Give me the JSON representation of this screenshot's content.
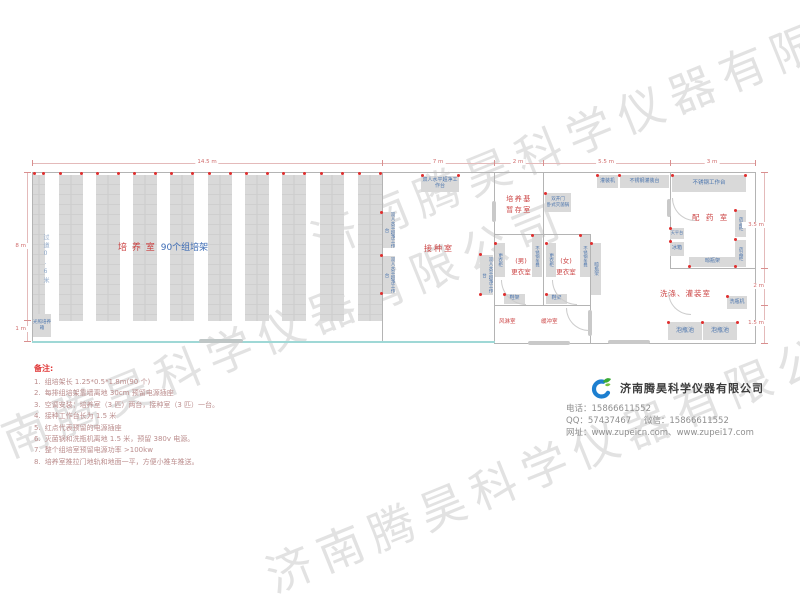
{
  "watermark": {
    "text": "济南腾昊科学仪器有限公司"
  },
  "dims": {
    "top": [
      "14.5 m",
      "7 m",
      "2 m",
      "5.5 m",
      "3 m"
    ],
    "left": [
      "8 m",
      "1 m"
    ],
    "right": [
      "3.5 m",
      "2 m",
      "1.5 m"
    ]
  },
  "plan": {
    "culture_room": {
      "name": "培 养 室",
      "rack_note": "90个组培架",
      "aisle": "过道0.6米",
      "incubator": "光照培养箱"
    },
    "inoculation_room": {
      "name": "接种室",
      "bench": "双人水平超净工作台"
    },
    "medium_room": {
      "name_line1": "培养基",
      "name_line2": "暂存室",
      "sterilizer_line1": "双开门",
      "sterilizer_line2": "卧式灭菌锅"
    },
    "changing_area": {
      "male_line1": "(男)",
      "male_line2": "更衣室",
      "female_line1": "(女)",
      "female_line2": "更衣室",
      "locker": "更衣柜",
      "steel_bench": "不锈钢条凳",
      "shoe_rack": "鞋架",
      "bottle_rack": "晾瓶架",
      "air_shower": "风淋室",
      "buffer_room": "缓冲室"
    },
    "dispensing_room": {
      "name": "配 药 室",
      "worktable": "不锈钢工作台",
      "medicine_cabinet": "药品柜",
      "balance_table": "天平台",
      "fridge": "冰箱",
      "bottle_rack": "晾瓶架"
    },
    "washing_room": {
      "name": "洗涤、灌装室",
      "filling_machine": "灌装机",
      "filling_table": "不锈钢灌装台",
      "bottle_washer": "洗瓶机",
      "soak_pool": "泡瓶池"
    }
  },
  "notes": {
    "title": "备注:",
    "items": [
      {
        "n": "1.",
        "t": "组培架长 1.25*0.5*1.8m(90 个)"
      },
      {
        "n": "2.",
        "t": "每排组培架靠墙离地 30cm 预留电源插座"
      },
      {
        "n": "3.",
        "t": "空调安装：培养室（3 匹）两台，接种室（3 匹）一台。"
      },
      {
        "n": "4.",
        "t": "接种工作台长为 1.5 米"
      },
      {
        "n": "5.",
        "t": "红点代表预留的电源插座"
      },
      {
        "n": "6.",
        "t": "灭菌锅和洗瓶机离地 1.5 米，预留 380v 电源。"
      },
      {
        "n": "7.",
        "t": "整个组培室预留电源功率 >100kw"
      },
      {
        "n": "8.",
        "t": "培养室推拉门地轨和地面一平，方便小推车推送。"
      }
    ]
  },
  "company": {
    "name": "济南腾昊科学仪器有限公司",
    "phone_label": "电话：",
    "phone": "15866611552",
    "qq_label": "QQ：",
    "qq": "57437467",
    "wechat_label": "微信：",
    "wechat": "15866611552",
    "web_label": "网址：",
    "web1": "www.zupeicn.com",
    "web_sep": "、",
    "web2": "www.zupei17.com"
  }
}
